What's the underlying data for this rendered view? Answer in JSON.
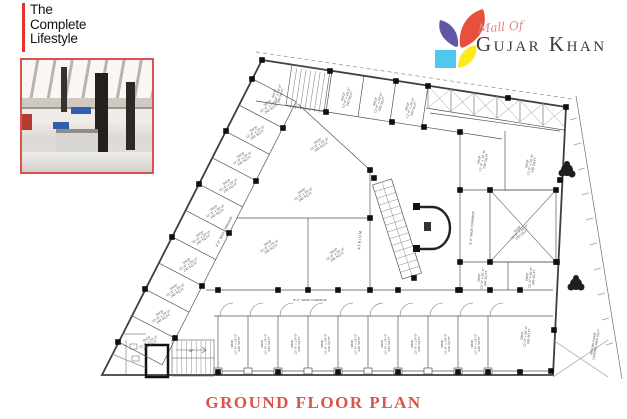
{
  "branding": {
    "tagline_lines": [
      "The",
      "Complete",
      "Lifestyle"
    ],
    "accent_color": "#e4342c"
  },
  "logo": {
    "script_text": "Mall Of",
    "name_text": "Gujar Khan",
    "petal_red": "#e94f3d",
    "petal_purple": "#5d57a6",
    "petal_cyan": "#4fc8f0",
    "petal_yellow": "#ffe81c"
  },
  "photo": {
    "caption": "mall interior photograph",
    "border_color": "#d9534f"
  },
  "title": {
    "text": "GROUND FLOOR PLAN",
    "color": "#d9554b"
  },
  "plan": {
    "ink": "#555555",
    "atrium_label": "ATRIUM",
    "corridor_label": "8'-0\" WIDE CORRIDOR",
    "shop_label_lines": [
      "SHOP",
      "12'-0\" x 20'-0\"",
      "240 SQ.FT"
    ],
    "stairs_label": "UP",
    "side_note_lines": [
      "GROUND FLOOR",
      "COVERED AREA SQ.FT"
    ]
  }
}
